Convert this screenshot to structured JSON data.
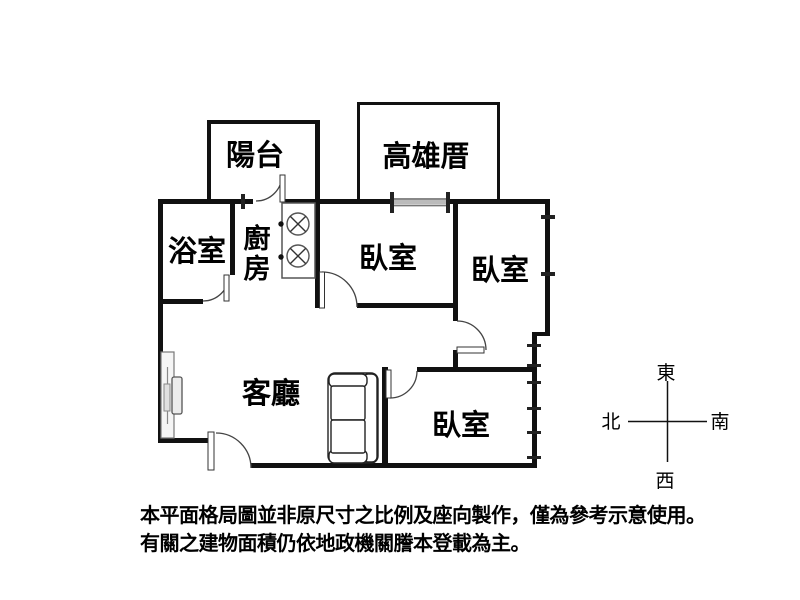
{
  "rooms": {
    "balcony": {
      "label": "陽台"
    },
    "kaohsiung_cuo": {
      "label": "高雄厝"
    },
    "bathroom": {
      "label": "浴室"
    },
    "kitchen": {
      "label": "廚房"
    },
    "bedroom_top": {
      "label": "臥室"
    },
    "bedroom_right": {
      "label": "臥室"
    },
    "bedroom_bottom": {
      "label": "臥室"
    },
    "living_room": {
      "label": "客廳"
    }
  },
  "compass": {
    "top": "東",
    "left": "北",
    "right": "南",
    "bottom": "西"
  },
  "disclaimer": {
    "line1": "本平面格局圖並非原尺寸之比例及座向製作，僅為參考示意使用。",
    "line2": "有關之建物面積仍依地政機關謄本登載為主。"
  },
  "colors": {
    "wall": "#111111",
    "background": "#ffffff",
    "window_gray": "#9a9a9a"
  }
}
